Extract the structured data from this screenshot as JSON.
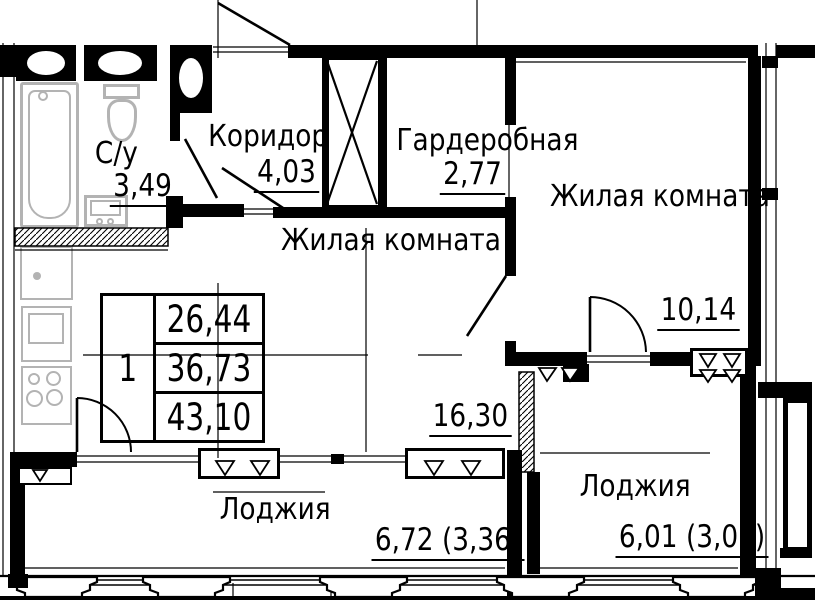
{
  "plan": {
    "rooms": [
      {
        "id": "bathroom",
        "label": "С/у",
        "area": "3,49"
      },
      {
        "id": "corridor",
        "label": "Коридор",
        "area": "4,03"
      },
      {
        "id": "wardrobe",
        "label": "Гардеробная",
        "area": "2,77"
      },
      {
        "id": "living-room-right",
        "label": "Жилая комната",
        "area": "10,14"
      },
      {
        "id": "living-room-main",
        "label": "Жилая комната",
        "area": "16,30"
      },
      {
        "id": "loggia-left",
        "label": "Лоджия",
        "area": "6,72 (3,36)"
      },
      {
        "id": "loggia-right",
        "label": "Лоджия",
        "area": "6,01 (3,01)"
      }
    ],
    "stamp": {
      "rooms_count": "1",
      "values": [
        "26,44",
        "36,73",
        "43,10"
      ]
    },
    "colors": {
      "line": "#000000",
      "fixture": "#b3b3b3",
      "background": "#ffffff"
    }
  }
}
